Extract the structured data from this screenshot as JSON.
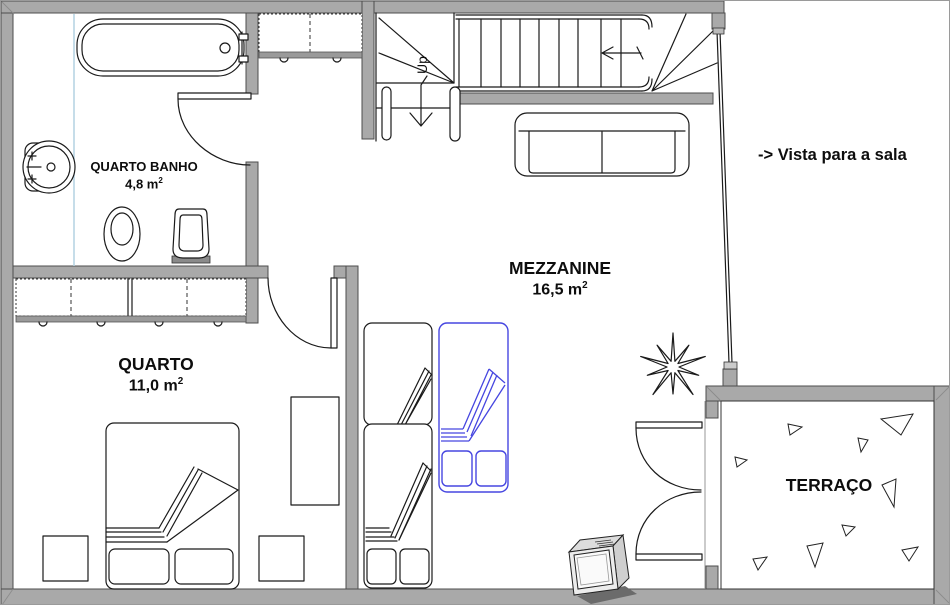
{
  "rooms": {
    "bathroom": {
      "name": "QUARTO BANHO",
      "area_value": "4,8 m",
      "area_exponent": "2"
    },
    "bedroom": {
      "name": "QUARTO",
      "area_value": "11,0 m",
      "area_exponent": "2"
    },
    "mezzanine": {
      "name": "MEZZANINE",
      "area_value": "16,5 m",
      "area_exponent": "2"
    },
    "terrace": {
      "name": "TERRAÇO"
    }
  },
  "annotations": {
    "view_note": "-> Vista para a sala",
    "stair_direction": "Up"
  },
  "icons": {
    "tv": "tv-icon",
    "plant": "plant-icon"
  },
  "colors": {
    "wall_fill": "#a9a9a9",
    "outline": "#1a1a1a",
    "highlight_bed": "#4646e0",
    "shower_line": "#b4d2e2"
  }
}
